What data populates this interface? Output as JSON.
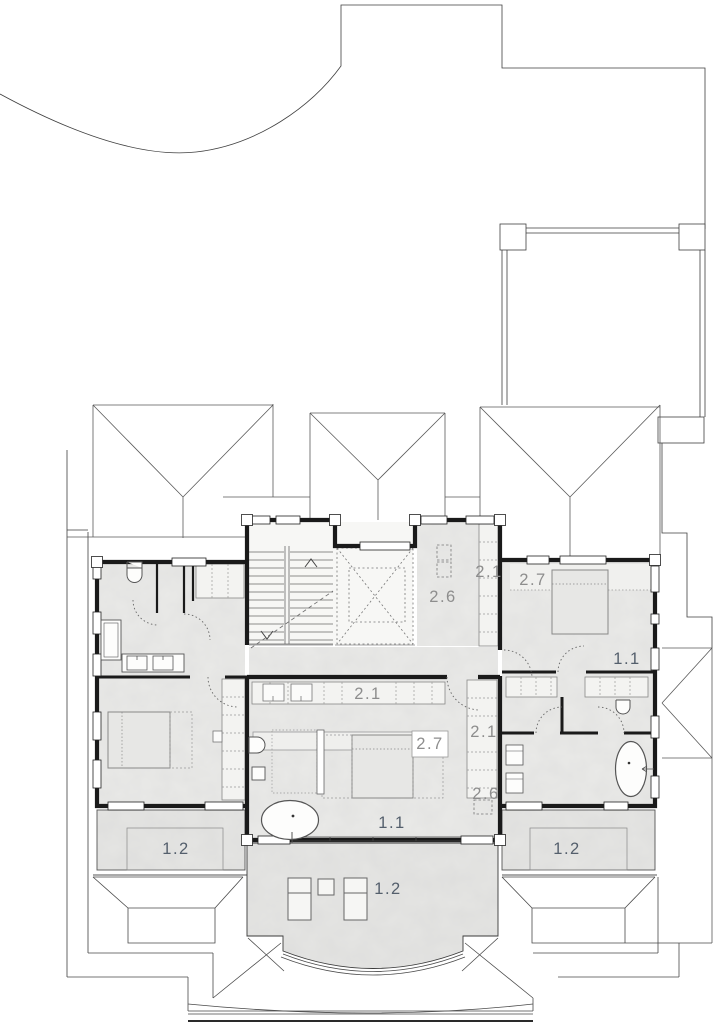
{
  "page": {
    "background": "#ffffff",
    "drawing_type": "architectural upper-floor plan"
  },
  "room_labels": [
    {
      "code": "2.6"
    },
    {
      "code": "2.1"
    },
    {
      "code": "2.7"
    },
    {
      "code": "1.1"
    },
    {
      "code": "2.1"
    },
    {
      "code": "2.1"
    },
    {
      "code": "2.7"
    },
    {
      "code": "2.6"
    },
    {
      "code": "1.1"
    },
    {
      "code": "1.2"
    },
    {
      "code": "1.2"
    },
    {
      "code": "1.2"
    }
  ],
  "label_colors": {
    "category_1": "#545f6c",
    "category_2": "#8d8d8d"
  },
  "line_colors": {
    "wall": "#1a1a1a",
    "site": "#3f3f3f",
    "roof": "#5a5a5a",
    "fixture": "#555555"
  },
  "floor_colors": {
    "interior": "#eaeae8",
    "balcony": "#e5e5e3",
    "stair": "#f7f7f5",
    "closet": "#f3f3f1"
  }
}
